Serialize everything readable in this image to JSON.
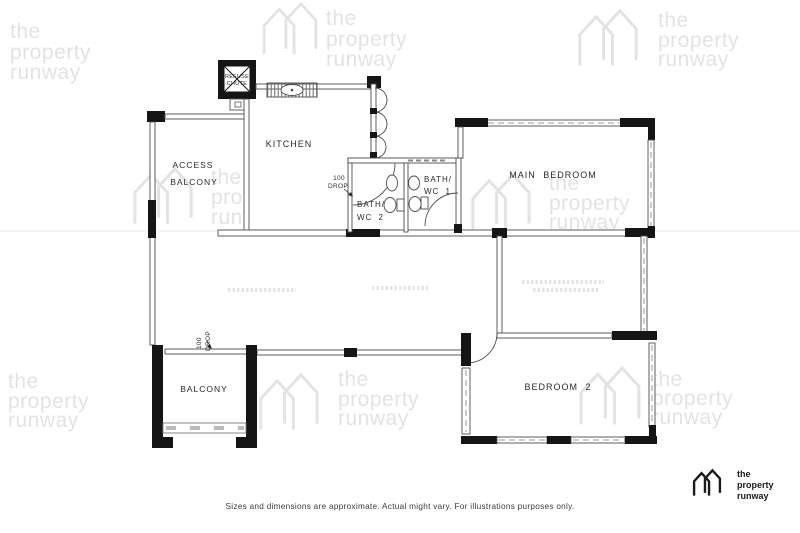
{
  "watermark": {
    "line1": "the",
    "line2": "property",
    "line3": "runway",
    "color": "#e3e3e3"
  },
  "brand": {
    "line1": "the",
    "line2": "property",
    "line3": "runway",
    "color": "#1b1b1b"
  },
  "rooms": {
    "kitchen": "KITCHEN",
    "access1": "ACCESS",
    "access2": "BALCONY",
    "main_bedroom": "MAIN BEDROOM",
    "bedroom2": "BEDROOM 2",
    "balcony": "BALCONY",
    "bath1a": "BATH/",
    "bath1b": "WC 1",
    "bath2a": "BATH/",
    "bath2b": "WC 2",
    "refuse1": "REFUSE",
    "refuse2": "CHUTE"
  },
  "notes": {
    "drop_kitchen_a": "100",
    "drop_kitchen_b": "DROP",
    "drop_balcony_a": "100",
    "drop_balcony_b": "DROP"
  },
  "footer": {
    "disclaimer": "Sizes and dimensions are approximate. Actual might vary. For illustrations purposes only."
  },
  "colors": {
    "wall_fill": "#151515",
    "line": "#4d4d4d"
  }
}
